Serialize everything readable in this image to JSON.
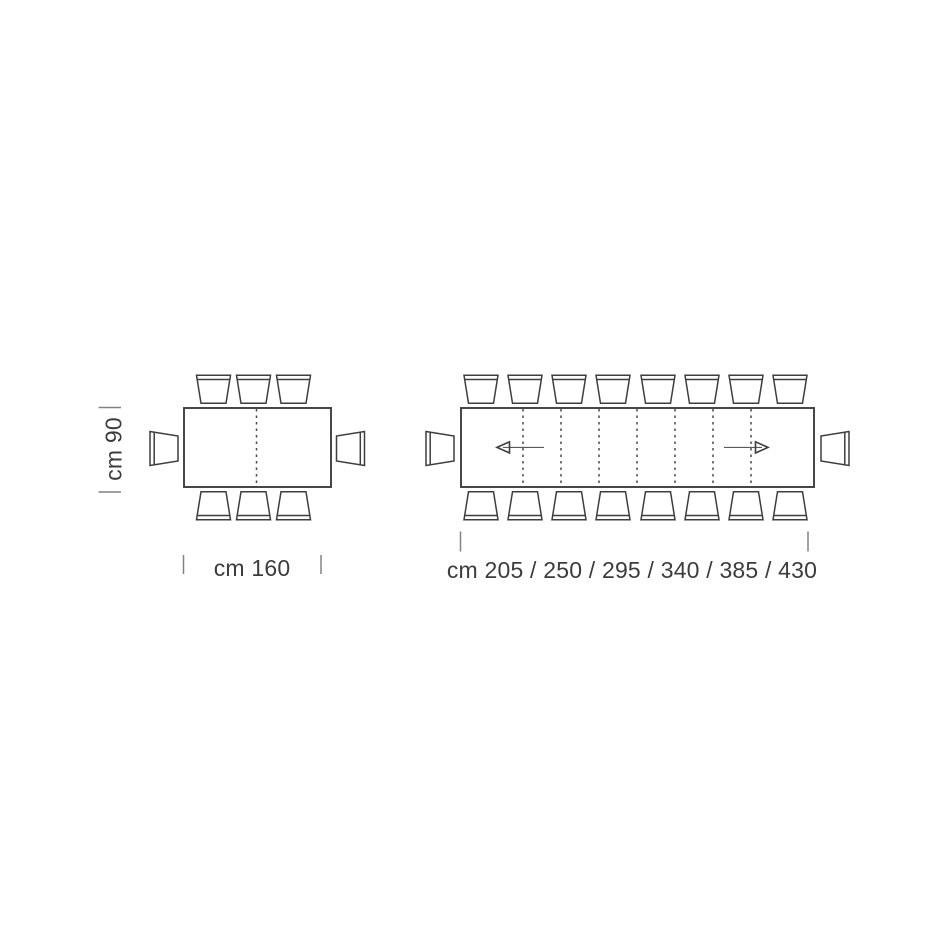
{
  "colors": {
    "background": "#ffffff",
    "line": "#3e3e3e",
    "dashed": "#4a4a4a",
    "dimension": "#828282",
    "arrow": "#5a5a5a",
    "text": "#3c3c3c"
  },
  "fixed_table": {
    "depth_label": "cm 90",
    "length_label": "cm 160",
    "chair_count": 8,
    "chairs": {
      "top": 3,
      "bottom": 3,
      "ends": 2
    },
    "leaf_lines": 1
  },
  "extendable_table": {
    "length_label": "cm 205 / 250 / 295 / 340 / 385 / 430",
    "lengths_cm": [
      205,
      250,
      295,
      340,
      385,
      430
    ],
    "chair_count": 18,
    "chairs": {
      "top": 8,
      "bottom": 8,
      "ends": 2
    },
    "leaf_lines": 7,
    "extension_arrows": [
      "left",
      "right"
    ]
  }
}
